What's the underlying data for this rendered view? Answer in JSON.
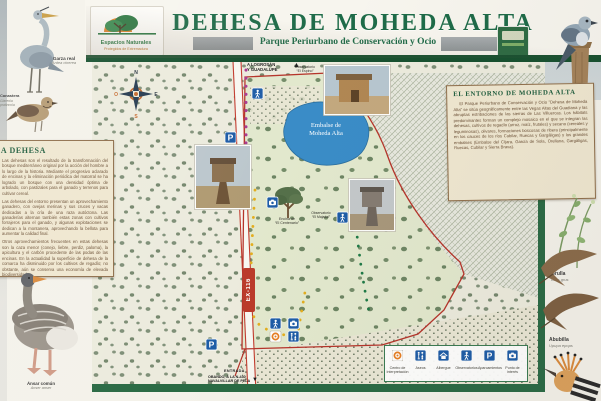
{
  "header": {
    "logo_line1": "Espacios Naturales",
    "logo_line2": "Protegidos de Extremadura",
    "title": "DEHESA DE MOHEDA ALTA",
    "subtitle": "Parque Periurbano de Conservación y Ocio"
  },
  "left_panel": {
    "title": "LA DEHESA",
    "p1": "Las dehesas son el resultado de la transformación del bosque mediterráneo original por la acción del hombre a lo largo de la historia. Mediante el progresivo aclarado de encinas y la eliminación periódica del matorral se ha logrado un bosque con una densidad óptima de arbolado, con pastizales para el ganado y terrenos para cultivar cereal.",
    "p2": "Las dehesas del entorno presentan un aprovechamiento ganadero, con ovejas merinas y sus cruces y vacas dedicadas a la cría de una raza autóctona. Las ganaderías alternan también estas zonas con cultivos forrajeros para el ganado, y algunas explotaciones se dedican a la montanera, aprovechando la bellota para aumentar la calidad final.",
    "p3": "Otros aprovechamientos frecuentes en estas dehesas son la caza menor (conejo, liebre, perdiz, paloma), la apicultura y el carbón procedente de las podas de las encinas. En la actualidad la superficie de dehesa de la comarca ha disminuido por los cultivos de regadío; no obstante, aún se conserva una economía de elevada biodiversidad."
  },
  "right_panel": {
    "title": "EL ENTORNO DE MOHEDA ALTA",
    "p1": "El Parque Periurbano de Conservación y Ocio \"Dehesa de Moheda Alta\" se sitúa geográficamente entre las Vegas Altas del Guadiana y las abruptas estribaciones de las sierras de Las Villuercas. Los hábitats predominantes forman un complejo mosaico en el que se integran las dehesas, cultivos de regadío (arroz, maíz, frutales) y secano (cereales y leguminosas), olivares, formaciones boscosas de ribera (principalmente en los cauces de los ríos Cubilar, Ruecas y Gargáligas) y los grandes embalses (Embalse del Cíjara, García de Sola, Orellana, Gargáligas, Ruecas, Cubilar y Sierra Brava)."
  },
  "map": {
    "dest_top_1": "A LOGROSÁN",
    "dest_top_2": "Y GUADALUPE",
    "dest_bottom_1": "OBANDO, A LA N-430",
    "dest_bottom_2": "NAVALVILLAR DE PELA",
    "road_name": "EX-116",
    "entrance": "ENTRADA",
    "lake_1": "Embalse de",
    "lake_2": "Moheda Alta",
    "obs_top_1": "Observatorio",
    "obs_top_2": "“El Espino”",
    "obs_right_1": "Observatorio",
    "obs_right_2": "“El Majadal”",
    "tree_1": "Encina de",
    "tree_2": "“El Centenario”",
    "compass": {
      "n": "N",
      "s": "S",
      "e": "E",
      "o": "O"
    },
    "legend": {
      "items": [
        {
          "label": "Centro de Interpretación"
        },
        {
          "label": "Aseos"
        },
        {
          "label": "Albergue"
        },
        {
          "label": "Observatorios"
        },
        {
          "label": "Aparcamientos"
        },
        {
          "label": "Punto de interés"
        }
      ]
    }
  },
  "wildlife": {
    "garza": {
      "name": "Garza real",
      "latin": "Ardea cinerea"
    },
    "canastera": {
      "name": "Canastera",
      "latin": "Glareola pratincola"
    },
    "ansar": {
      "name": "Ánsar común",
      "latin": "Anser anser"
    },
    "grulla": {
      "name": "Grulla",
      "latin": "Grus grus"
    },
    "abubilla": {
      "name": "Abubilla",
      "latin": "Upupa epops"
    }
  },
  "colors": {
    "brand_green": "#1e6b48",
    "bar_green": "#17502f",
    "panel_cream": "#efe7d0",
    "panel_border": "#8f6f4c",
    "lake_blue": "#3a8cc7",
    "icon_blue": "#1e5ca6",
    "boundary_red": "#b5342a",
    "trail_yellow": "#e3ae1f",
    "trail_magenta": "#a83a92",
    "trail_green": "#1e7a46",
    "centro_orange": "#e67e22"
  }
}
